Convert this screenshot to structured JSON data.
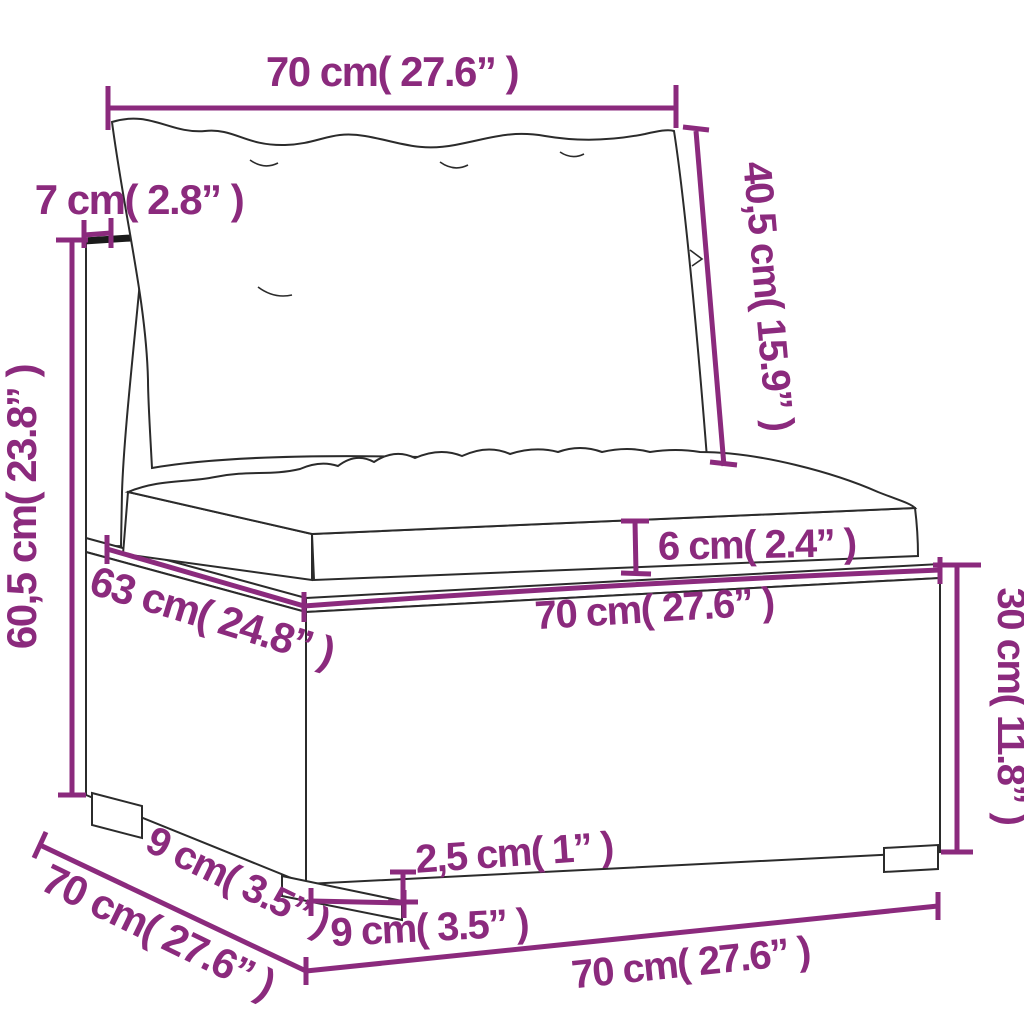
{
  "figure": {
    "accent_color": "#8b2a7d",
    "ink_color": "#2b2b2b",
    "background": "#ffffff"
  },
  "dims": [
    {
      "name": "back-width-top",
      "label": "70 cm( 27.6” )"
    },
    {
      "name": "back-cushion-height",
      "label": "40,5 cm( 15.9” )"
    },
    {
      "name": "armrest-top-width",
      "label": "7 cm( 2.8” )"
    },
    {
      "name": "total-height",
      "label": "60,5 cm( 23.8” )"
    },
    {
      "name": "seat-cushion-thickness",
      "label": "6 cm( 2.4” )"
    },
    {
      "name": "seat-front-width",
      "label": "70 cm( 27.6” )"
    },
    {
      "name": "seat-depth",
      "label": "63 cm( 24.8” )"
    },
    {
      "name": "base-height",
      "label": "30 cm( 11.8” )"
    },
    {
      "name": "leg-height",
      "label": "2,5 cm( 1” )"
    },
    {
      "name": "front-leg-width",
      "label": "9 cm( 3.5” )"
    },
    {
      "name": "side-leg-depth",
      "label": "9 cm( 3.5” )"
    },
    {
      "name": "side-depth-total",
      "label": "70 cm( 27.6” )"
    },
    {
      "name": "bottom-front-width",
      "label": "70 cm( 27.6” )"
    }
  ]
}
